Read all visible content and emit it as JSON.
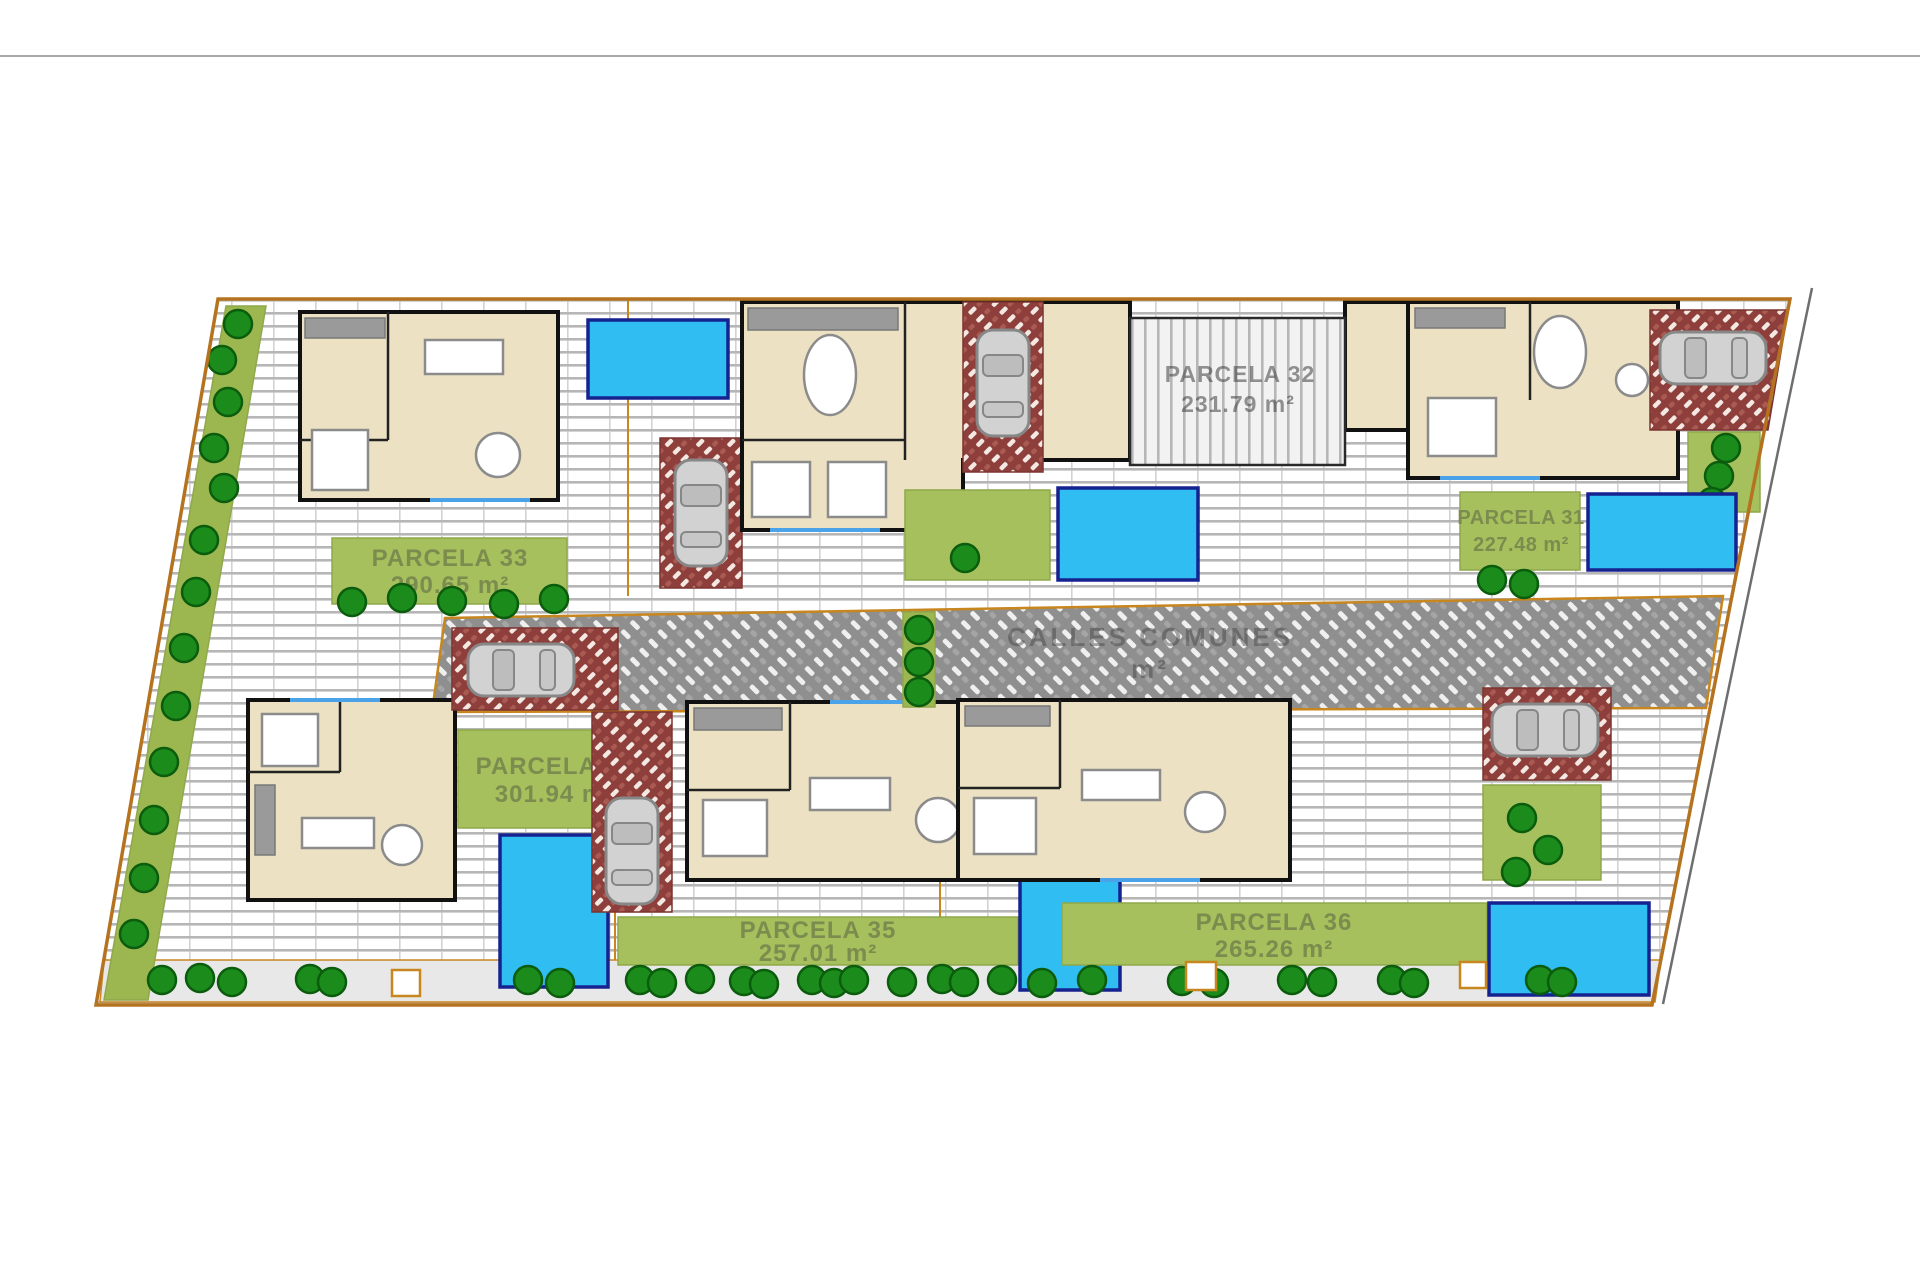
{
  "street": {
    "label": "CALLES COMUNES",
    "area_unit": "m²"
  },
  "parcels": [
    {
      "name": "PARCELA 31",
      "area": "227.48 m²"
    },
    {
      "name": "PARCELA 32",
      "area": "231.79 m²"
    },
    {
      "name": "PARCELA 33",
      "area": "290.65 m²"
    },
    {
      "name": "PARCELA 34",
      "area": "301.94 m²"
    },
    {
      "name": "PARCELA 35",
      "area": "257.01 m²"
    },
    {
      "name": "PARCELA 36",
      "area": "265.26 m²"
    }
  ],
  "colors": {
    "pool": "#2fbdf2",
    "pool_border": "#16228f",
    "grass": "#a6c05d",
    "grass_border": "#8fa84b",
    "label_text": "#7b8c4e",
    "driveway": "#8e3f3b",
    "boundary": "#b5731f",
    "street_paving": "#8f8f8f",
    "tree": "#1b8c1b"
  }
}
